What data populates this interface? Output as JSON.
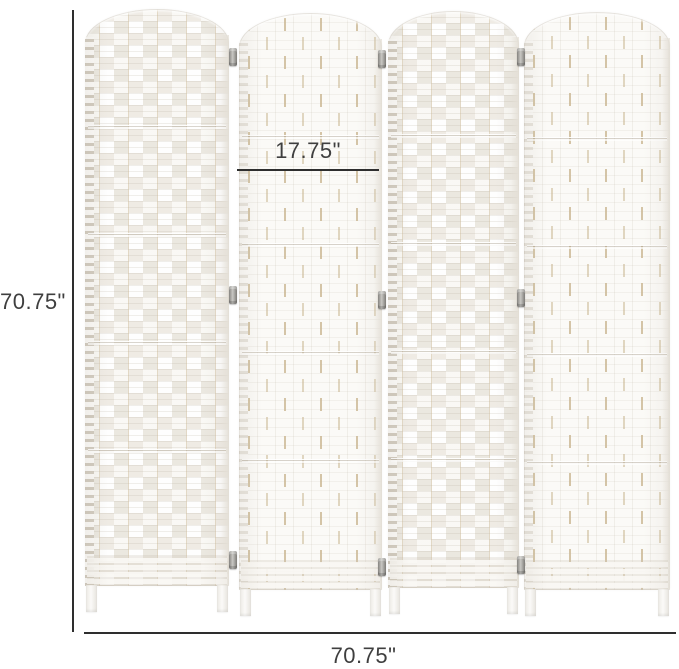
{
  "product": {
    "type": "4-panel woven folding room divider",
    "panel_count": 4,
    "finish": "white"
  },
  "dimensions": {
    "overall_height_label": "70.75\"",
    "overall_width_label": "70.75\"",
    "panel_width_label": "17.75\""
  },
  "colors": {
    "background": "#ffffff",
    "annotation_line": "#2e2e2e",
    "annotation_text": "#3f3f3f",
    "panel_white": "#fbfaf7",
    "panel_shaded": "#f3f0ea",
    "weave_tan": "#d6c7ab",
    "hinge_gray": "#8f8d89"
  }
}
